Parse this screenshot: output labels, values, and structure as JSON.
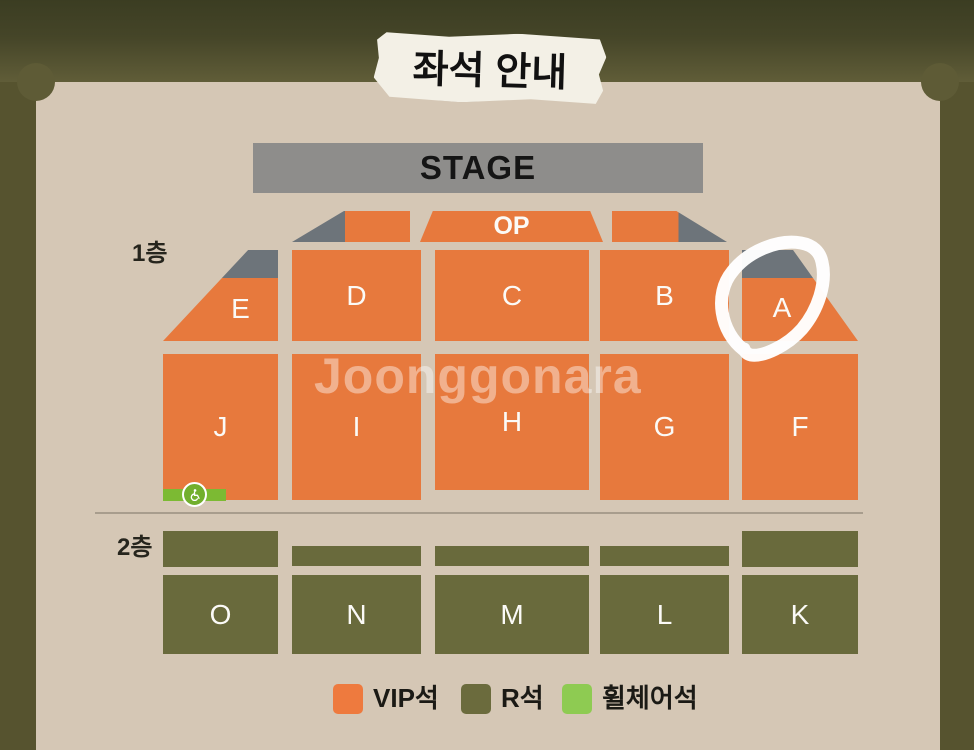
{
  "title_tape": {
    "text": "좌석 안내"
  },
  "stage": {
    "label": "STAGE"
  },
  "op": {
    "label": "OP"
  },
  "floor_labels": {
    "floor1": "1층",
    "floor2": "2층"
  },
  "sections": {
    "row1": [
      "E",
      "D",
      "C",
      "B",
      "A"
    ],
    "row2": [
      "J",
      "I",
      "H",
      "G",
      "F"
    ],
    "floor2": [
      "O",
      "N",
      "M",
      "L",
      "K"
    ]
  },
  "legend": {
    "items": [
      {
        "label": "VIP석",
        "color": "#ee7a3e"
      },
      {
        "label": "R석",
        "color": "#6b6b3d"
      },
      {
        "label": "휠체어석",
        "color": "#8ecb52"
      }
    ]
  },
  "watermark": {
    "text": "Joonggonara"
  },
  "annotation": {
    "shape": "hand-drawn marker circle",
    "target_section": "A",
    "color": "#ffffff"
  },
  "colors": {
    "vip_seat_orange": "#e7793d",
    "r_seat_olive": "#696a3c",
    "wheelchair_green": "#7cba33",
    "stage_gray": "#8e8d8b",
    "corner_gray": "#6d747a",
    "background_olive": "#56532f",
    "panel_beige": "#d5c7b5"
  }
}
